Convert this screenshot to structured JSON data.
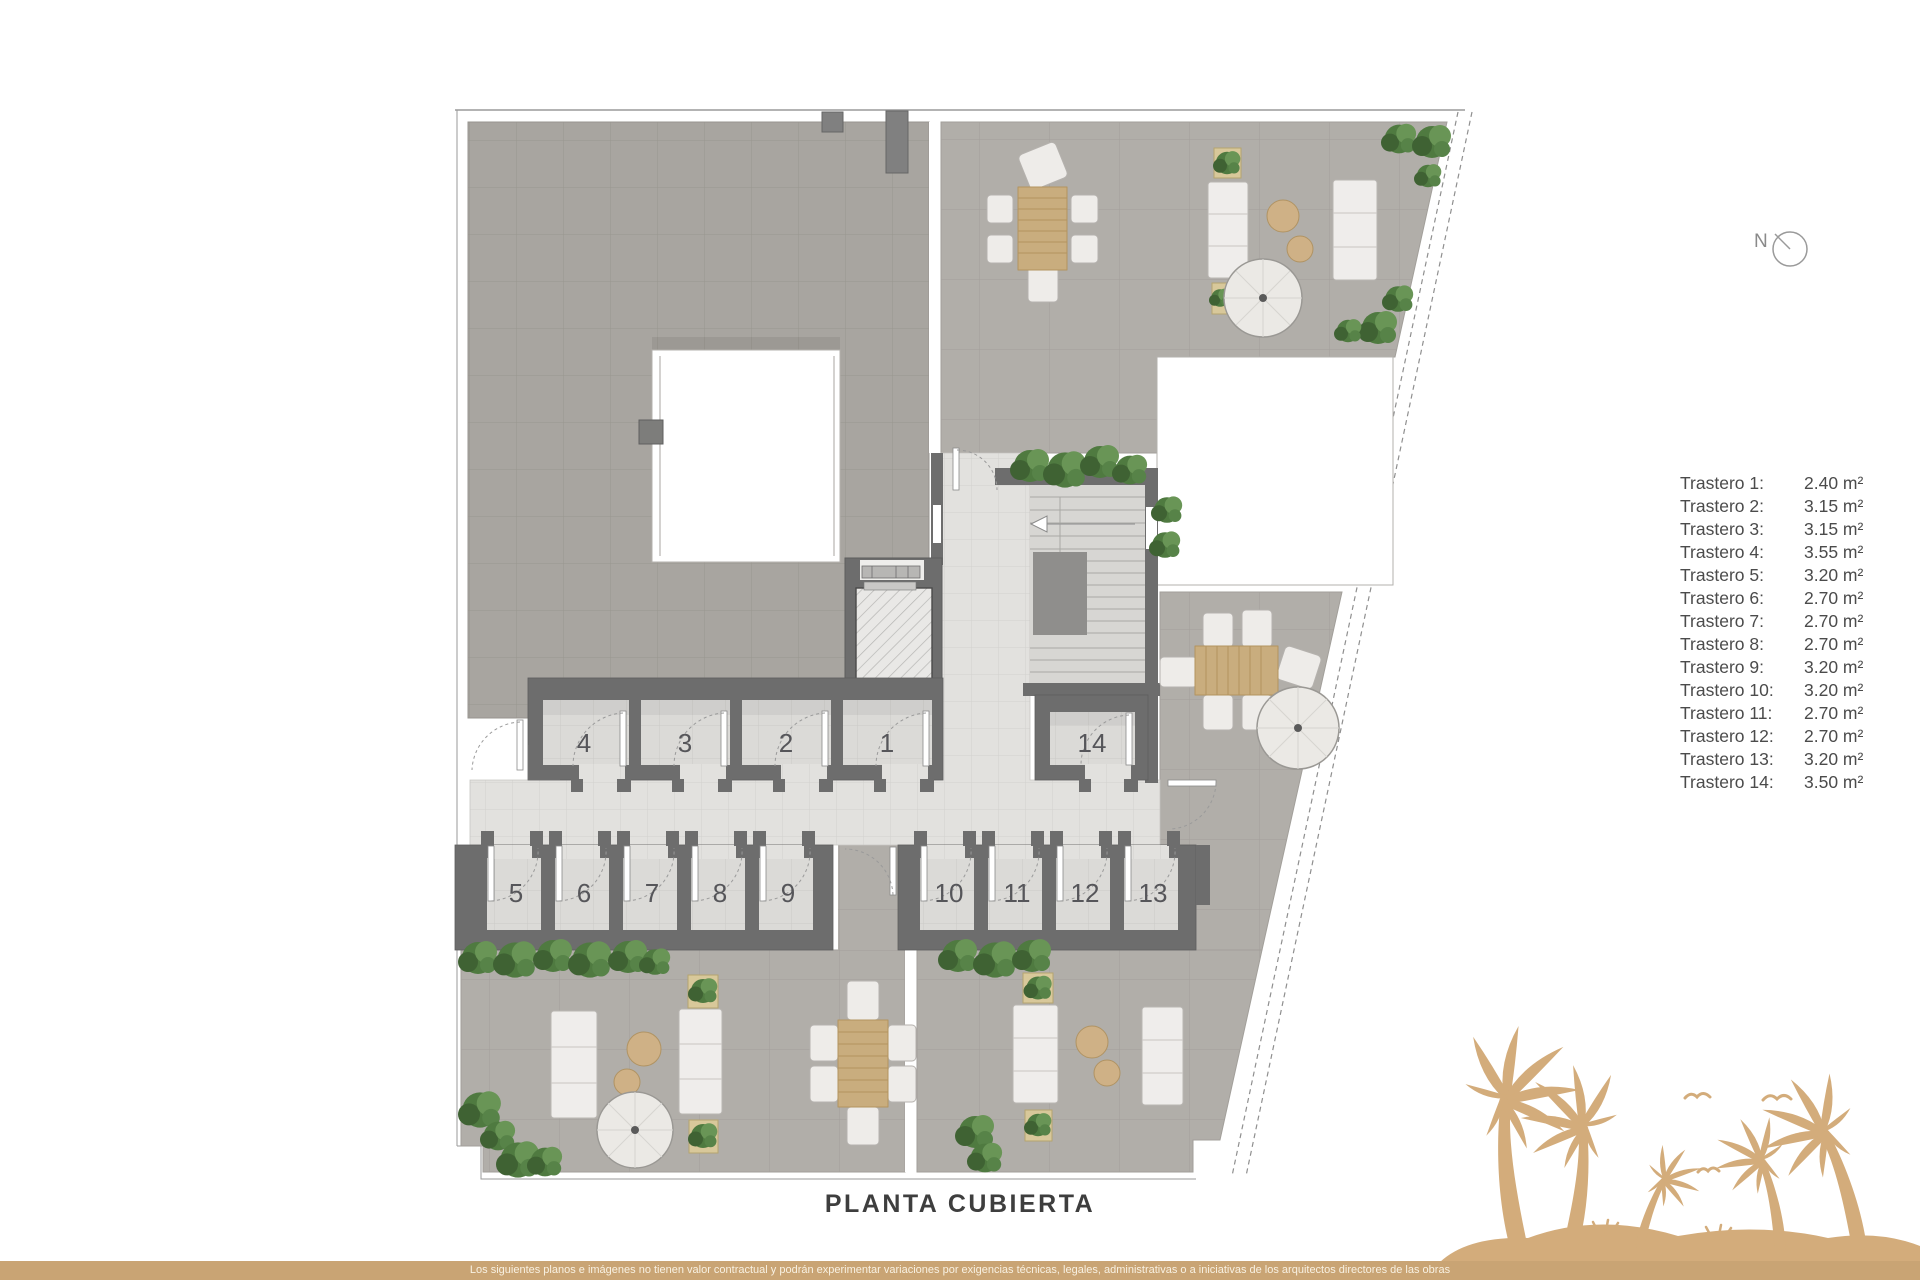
{
  "title": "PLANTA CUBIERTA",
  "compass": {
    "label": "N"
  },
  "legend": {
    "items": [
      {
        "label": "Trastero 1:",
        "area": "2.40 m²"
      },
      {
        "label": "Trastero 2:",
        "area": "3.15 m²"
      },
      {
        "label": "Trastero 3:",
        "area": "3.15 m²"
      },
      {
        "label": "Trastero 4:",
        "area": "3.55 m²"
      },
      {
        "label": "Trastero 5:",
        "area": "3.20 m²"
      },
      {
        "label": "Trastero 6:",
        "area": "2.70 m²"
      },
      {
        "label": "Trastero 7:",
        "area": "2.70 m²"
      },
      {
        "label": "Trastero 8:",
        "area": "2.70 m²"
      },
      {
        "label": "Trastero 9:",
        "area": "3.20 m²"
      },
      {
        "label": "Trastero 10:",
        "area": "3.20 m²"
      },
      {
        "label": "Trastero 11:",
        "area": "2.70 m²"
      },
      {
        "label": "Trastero 12:",
        "area": "2.70 m²"
      },
      {
        "label": "Trastero 13:",
        "area": "3.20 m²"
      },
      {
        "label": "Trastero 14:",
        "area": "3.50 m²"
      }
    ]
  },
  "plan": {
    "rooms": [
      {
        "number": "1"
      },
      {
        "number": "2"
      },
      {
        "number": "3"
      },
      {
        "number": "4"
      },
      {
        "number": "5"
      },
      {
        "number": "6"
      },
      {
        "number": "7"
      },
      {
        "number": "8"
      },
      {
        "number": "9"
      },
      {
        "number": "10"
      },
      {
        "number": "11"
      },
      {
        "number": "12"
      },
      {
        "number": "13"
      },
      {
        "number": "14"
      }
    ]
  },
  "footer": {
    "disclaimer": "Los siguientes planos e imágenes no tienen valor contractual y podrán experimentar variaciones por exigencias técnicas, legales, administrativas o a iniciativas de los arquitectos directores de las obras"
  },
  "colors": {
    "accent_tan": "#d3ac7b",
    "wall_gray": "#6d6d6d",
    "plant_green": "#4f7a40"
  }
}
